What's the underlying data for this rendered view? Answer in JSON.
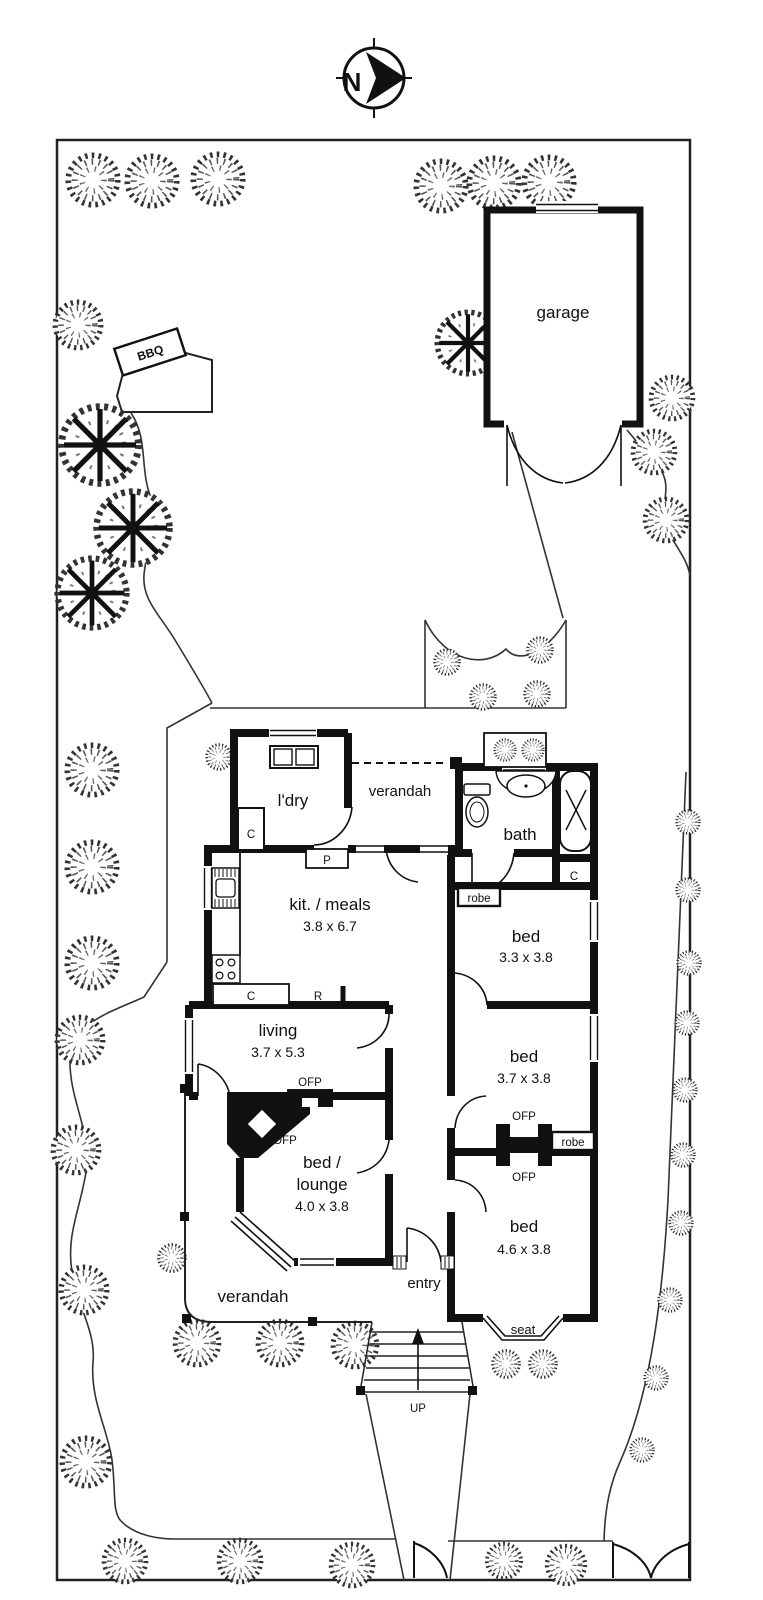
{
  "compass": {
    "north": "N"
  },
  "site": {
    "garage": "garage",
    "bbq": "BBQ"
  },
  "rooms": {
    "laundry": {
      "name": "l'dry"
    },
    "verandah_top": {
      "name": "verandah"
    },
    "bath": {
      "name": "bath"
    },
    "kitchen_meals": {
      "name": "kit. / meals",
      "dims": "3.8 x 6.7"
    },
    "bed1": {
      "name": "bed",
      "dims": "3.3 x 3.8"
    },
    "living": {
      "name": "living",
      "dims": "3.7 x 5.3"
    },
    "bed2": {
      "name": "bed",
      "dims": "3.7 x 3.8"
    },
    "bed_lounge": {
      "name_line1": "bed /",
      "name_line2": "lounge",
      "dims": "4.0 x 3.8"
    },
    "bed3": {
      "name": "bed",
      "dims": "4.6 x 3.8"
    },
    "entry": {
      "name": "entry"
    },
    "verandah_bottom": {
      "name": "verandah"
    }
  },
  "fixtures": {
    "cupboard": "C",
    "pantry": "P",
    "fridge": "R",
    "robe": "robe",
    "fireplace": "OFP",
    "seat": "seat",
    "stairs_up": "UP"
  },
  "colors": {
    "ink": "#111111",
    "paper": "#ffffff"
  }
}
